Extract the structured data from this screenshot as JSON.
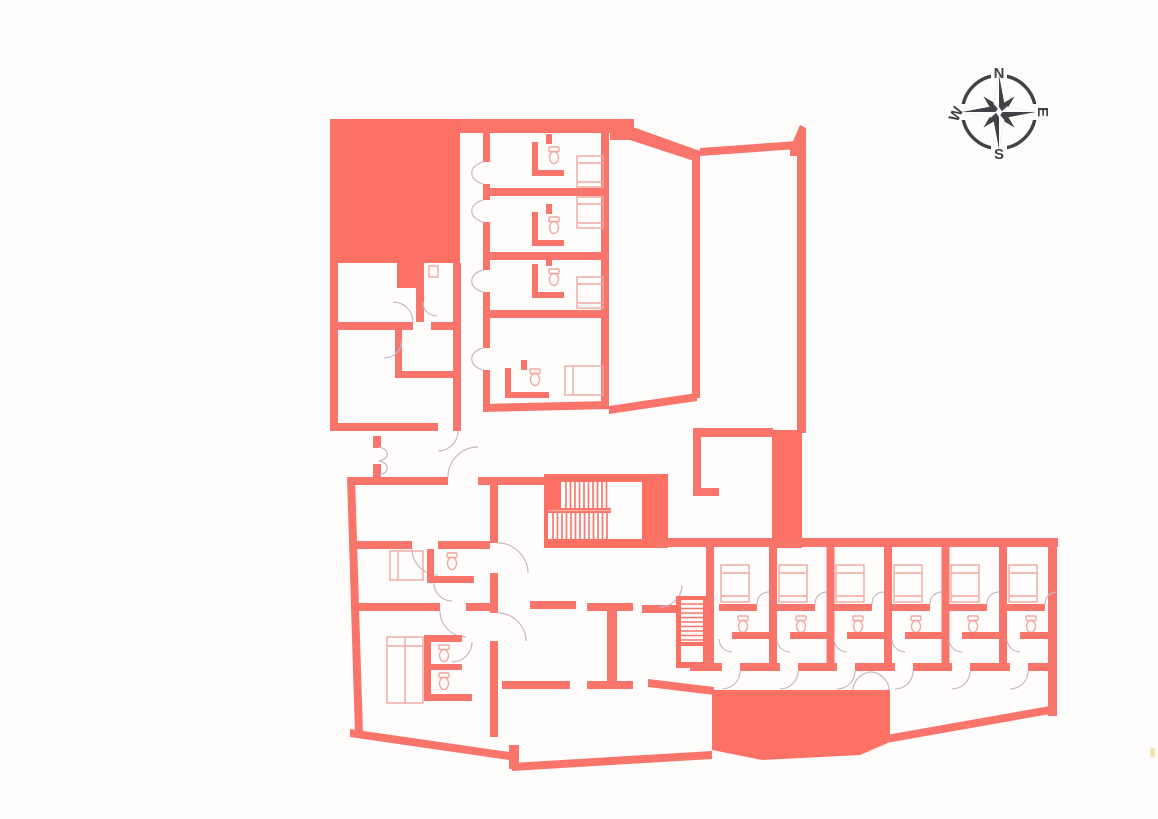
{
  "compass": {
    "north": "N",
    "east": "E",
    "south": "S",
    "west": "W"
  },
  "palette": {
    "background": "#fffcfc",
    "wall": "#f9746a",
    "solid_fill": "#fc7164",
    "furniture_line": "#f2a89e",
    "door_swing": "#c8b7c6",
    "compass_ink": "#3f4347",
    "edge_tick": "#f6dca5"
  },
  "plan": {
    "type": "architectural-floor-plan",
    "right_wing_guest_rooms": 6,
    "upper_guest_rooms": 4,
    "staircases": 2
  }
}
